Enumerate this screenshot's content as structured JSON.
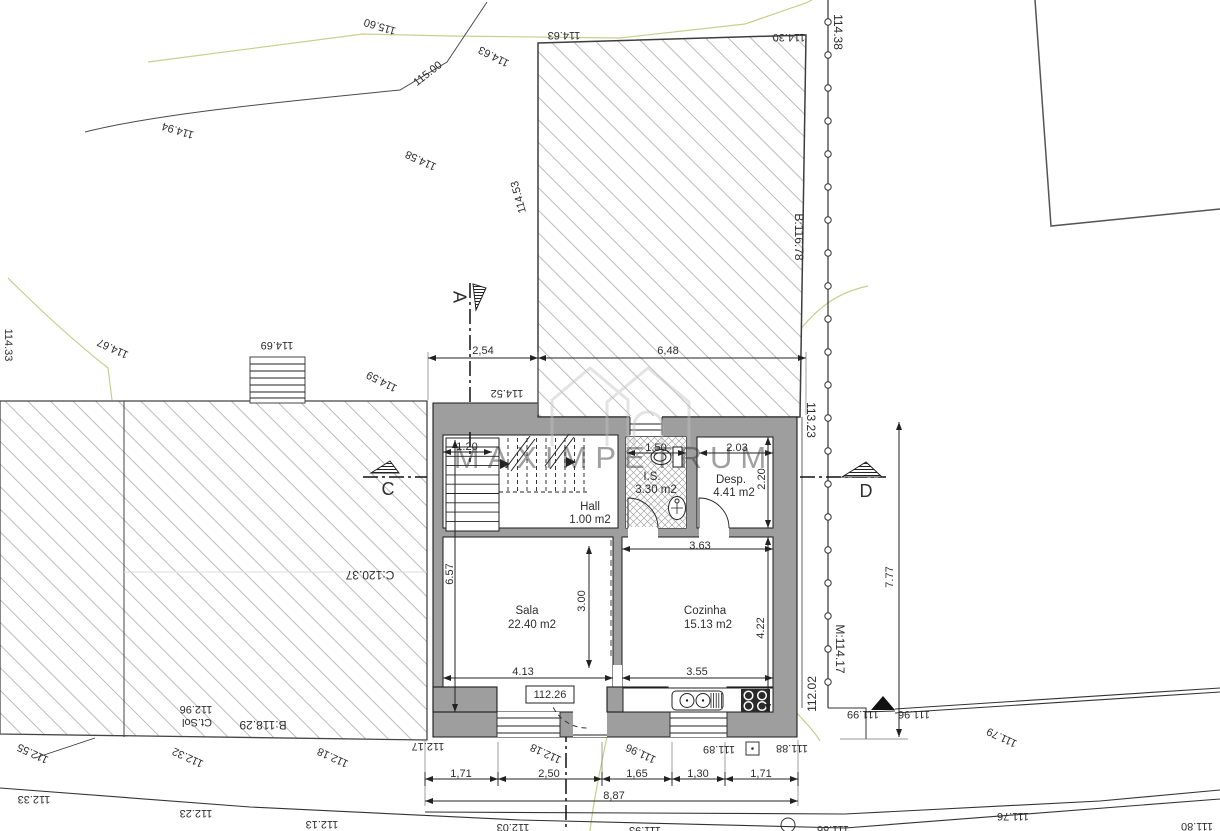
{
  "watermark": {
    "text": "MAXIMPETRUM",
    "logo": "house-outline-logo"
  },
  "levels": {
    "floor_level_boxed": "112.26"
  },
  "rooms": [
    {
      "name": "Hall",
      "area": "1.00 m2",
      "nx": 590,
      "ny": 507,
      "ax": 590,
      "ay": 520
    },
    {
      "name": "I.S.",
      "area": "3.30 m2",
      "nx": 652,
      "ny": 477,
      "ax": 656,
      "ay": 490
    },
    {
      "name": "Desp.",
      "area": "4.41 m2",
      "nx": 731,
      "ny": 480,
      "ax": 734,
      "ay": 493
    },
    {
      "name": "Sala",
      "area": "22.40 m2",
      "nx": 527,
      "ny": 611,
      "ax": 532,
      "ay": 625
    },
    {
      "name": "Cozinha",
      "area": "15.13 m2",
      "nx": 705,
      "ny": 611,
      "ax": 708,
      "ay": 625
    }
  ],
  "dimensions": [
    {
      "t": "2,54",
      "x": 483,
      "y": 351
    },
    {
      "t": "6,48",
      "x": 668,
      "y": 351
    },
    {
      "t": "1.20",
      "x": 467,
      "y": 447
    },
    {
      "t": "1.50",
      "x": 656,
      "y": 448
    },
    {
      "t": "2.03",
      "x": 737,
      "y": 448
    },
    {
      "t": "2.20",
      "x": 762,
      "y": 479,
      "r": -90
    },
    {
      "t": "6.57",
      "x": 450,
      "y": 574,
      "r": -90
    },
    {
      "t": "3.00",
      "x": 582,
      "y": 601,
      "r": -90
    },
    {
      "t": "3.63",
      "x": 700,
      "y": 546
    },
    {
      "t": "4.22",
      "x": 761,
      "y": 628,
      "r": -90
    },
    {
      "t": "4.13",
      "x": 523,
      "y": 672
    },
    {
      "t": "3.55",
      "x": 697,
      "y": 672
    },
    {
      "t": "1,71",
      "x": 461,
      "y": 774
    },
    {
      "t": "2,50",
      "x": 549,
      "y": 774
    },
    {
      "t": "1,65",
      "x": 637,
      "y": 774
    },
    {
      "t": "1,30",
      "x": 698,
      "y": 774
    },
    {
      "t": "1,71",
      "x": 761,
      "y": 774
    },
    {
      "t": "8,87",
      "x": 614,
      "y": 796
    },
    {
      "t": "7.77",
      "x": 890,
      "y": 577,
      "r": -90
    }
  ],
  "elevation_labels": [
    {
      "t": "115.60",
      "x": 380,
      "y": 26,
      "r": 197
    },
    {
      "t": "115.00",
      "x": 428,
      "y": 74,
      "r": -38
    },
    {
      "t": "114.94",
      "x": 178,
      "y": 130,
      "r": 197
    },
    {
      "t": "114.63",
      "x": 564,
      "y": 35,
      "r": 180
    },
    {
      "t": "114.63",
      "x": 494,
      "y": 56,
      "r": 207
    },
    {
      "t": "114.58",
      "x": 421,
      "y": 160,
      "r": 205
    },
    {
      "t": "114.53",
      "x": 519,
      "y": 197,
      "r": 255
    },
    {
      "t": "114.30",
      "x": 789,
      "y": 37,
      "r": 180
    },
    {
      "t": "114.38",
      "x": 837,
      "y": 32,
      "r": 90,
      "s": 12
    },
    {
      "t": "114.69",
      "x": 277,
      "y": 345,
      "r": 180
    },
    {
      "t": "114.59",
      "x": 382,
      "y": 381,
      "r": 207
    },
    {
      "t": "114.52",
      "x": 507,
      "y": 393,
      "r": 180
    },
    {
      "t": "114.67",
      "x": 113,
      "y": 348,
      "r": 205
    },
    {
      "t": "114.33",
      "x": 8,
      "y": 345,
      "r": 90
    },
    {
      "t": "B:116.78",
      "x": 798,
      "y": 237,
      "r": 90,
      "s": 12
    },
    {
      "t": "113.23",
      "x": 810,
      "y": 420,
      "r": 90,
      "s": 12
    },
    {
      "t": "M:114.17",
      "x": 839,
      "y": 649,
      "r": 90,
      "s": 12
    },
    {
      "t": "112.02",
      "x": 813,
      "y": 694,
      "r": -90,
      "s": 12
    },
    {
      "t": "C:120.37",
      "x": 370,
      "y": 574,
      "r": 180,
      "s": 12
    },
    {
      "t": "B:118.29",
      "x": 263,
      "y": 724,
      "r": 180,
      "s": 12
    },
    {
      "t": "Ct.Sol",
      "x": 197,
      "y": 722,
      "r": 180
    },
    {
      "t": "112.96",
      "x": 196,
      "y": 709,
      "r": 180
    },
    {
      "t": "112.55",
      "x": 33,
      "y": 753,
      "r": 205
    },
    {
      "t": "112.32",
      "x": 188,
      "y": 757,
      "r": 205
    },
    {
      "t": "112.18",
      "x": 333,
      "y": 757,
      "r": 205
    },
    {
      "t": "112.17",
      "x": 428,
      "y": 746,
      "r": 180
    },
    {
      "t": "112.18",
      "x": 546,
      "y": 753,
      "r": 205
    },
    {
      "t": "111.96",
      "x": 641,
      "y": 753,
      "r": 205
    },
    {
      "t": "111.89",
      "x": 719,
      "y": 749,
      "r": 180
    },
    {
      "t": "111.88",
      "x": 792,
      "y": 748,
      "r": 180
    },
    {
      "t": "111.99",
      "x": 863,
      "y": 714,
      "r": 180
    },
    {
      "t": "111.96",
      "x": 914,
      "y": 714,
      "r": 180
    },
    {
      "t": "111.79",
      "x": 1002,
      "y": 737,
      "r": 205
    },
    {
      "t": "111.76",
      "x": 1013,
      "y": 816,
      "r": 180
    },
    {
      "t": "112.33",
      "x": 34,
      "y": 799,
      "r": 180
    },
    {
      "t": "112.23",
      "x": 196,
      "y": 813,
      "r": 180
    },
    {
      "t": "112.13",
      "x": 322,
      "y": 824,
      "r": 180
    },
    {
      "t": "112.03",
      "x": 513,
      "y": 827,
      "r": 180
    },
    {
      "t": "111.93",
      "x": 645,
      "y": 830,
      "r": 180
    },
    {
      "t": "111.86",
      "x": 833,
      "y": 829,
      "r": 180
    },
    {
      "t": "111.80",
      "x": 1197,
      "y": 826,
      "r": 180
    }
  ],
  "section_markers": [
    {
      "label": "A",
      "x": 458,
      "y": 297,
      "r": 90
    },
    {
      "label": "C",
      "x": 388,
      "y": 490,
      "r": 0
    },
    {
      "label": "D",
      "x": 866,
      "y": 492,
      "r": 0
    }
  ]
}
